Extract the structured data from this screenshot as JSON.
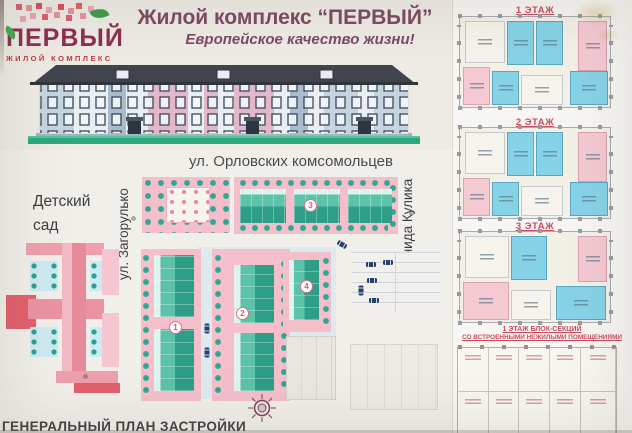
{
  "logo": {
    "name": "ПЕРВЫЙ",
    "subtitle": "ЖИЛОЙ КОМПЛЕКС"
  },
  "header": {
    "title": "Жилой комплекс “ПЕРВЫЙ”",
    "subtitle": "Европейское качество жизни!"
  },
  "site_plan": {
    "street_top": "ул. Орловских комсомольцев",
    "street_left": "ул. Загорулько",
    "street_right": "ул. Леонида Кулика",
    "kindergarten_label": "Детский сад",
    "caption": "ГЕНЕРАЛЬНЫЙ ПЛАН ЗАСТРОЙКИ",
    "building_markers": [
      "1",
      "2",
      "3",
      "4"
    ]
  },
  "floor_plans": {
    "labels": [
      "1 ЭТАЖ",
      "2 ЭТАЖ",
      "3 ЭТАЖ"
    ],
    "note_line1": "1 ЭТАЖ БЛОК-СЕКЦИЙ",
    "note_line2": "СО ВСТРОЕННЫМИ НЕЖИЛЫМИ ПОМЕЩЕНИЯМИ"
  },
  "colors": {
    "board_background": "#eeebe5",
    "title_maroon": "#7c4a64",
    "logo_dark_red": "#8d2f52",
    "logo_red": "#c23a44",
    "floor_label_red": "#cc4a5e",
    "plan_block_pink": "#f4bfcb",
    "kindergarten_pink": "#eb93a3",
    "building_teal": "#2f9e86",
    "tree_teal": "#2fa792",
    "room_blue": "#86d2e6",
    "room_pink": "#f4c9d2",
    "elevation_roof": "#40454d",
    "elevation_pink_section": "#e3b7ca",
    "elevation_blue_section": "#c6d4e0",
    "ground_green": "#2ba87d"
  }
}
